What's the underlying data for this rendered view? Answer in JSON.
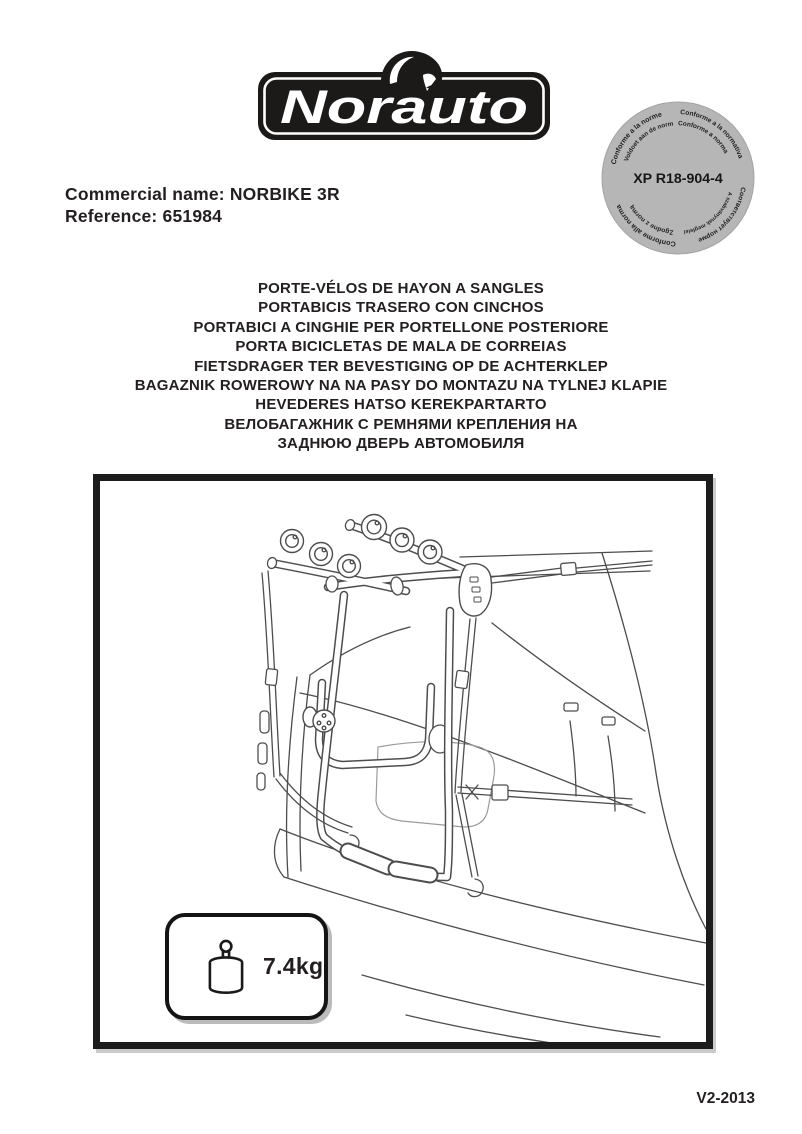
{
  "logo": {
    "brand": "Norauto"
  },
  "badge": {
    "center_code": "XP R18-904-4",
    "bg_color": "#b6b6b6",
    "ring": {
      "outer_top_left": "Conforme a la norme",
      "outer_top_right": "Conforme a la normativa",
      "inner_top_left": "Voldoet aan de norm",
      "inner_top_right": "Conforme a norma",
      "outer_bottom_right": "Соответствует норме",
      "outer_bottom_left": "Conforme alla norma",
      "inner_bottom_right": "A szabványnak megfelelő",
      "inner_bottom_left": "Zgodne z normą"
    }
  },
  "product": {
    "commercial_name": "Commercial name: NORBIKE 3R",
    "reference": "Reference: 651984"
  },
  "titles": {
    "lines": [
      "PORTE-VÉLOS DE HAYON A SANGLES",
      "PORTABICIS TRASERO CON CINCHOS",
      "PORTABICI A CINGHIE PER PORTELLONE POSTERIORE",
      "PORTA BICICLETAS DE MALA DE CORREIAS",
      "FIETSDRAGER TER BEVESTIGING OP DE ACHTERKLEP",
      "BAGAZNIK ROWEROWY NA NA PASY DO MONTAZU NA TYLNEJ KLAPIE",
      "HEVEDERES HATSO KEREKPARTARTO",
      "ВЕЛОБАГАЖНИК С РЕМНЯМИ КРЕПЛЕНИЯ НА",
      "ЗАДНЮЮ ДВЕРЬ АВТОМОБИЛЯ"
    ]
  },
  "figure": {
    "weight": "7.4kg"
  },
  "footer": {
    "version": "V2-2013"
  }
}
